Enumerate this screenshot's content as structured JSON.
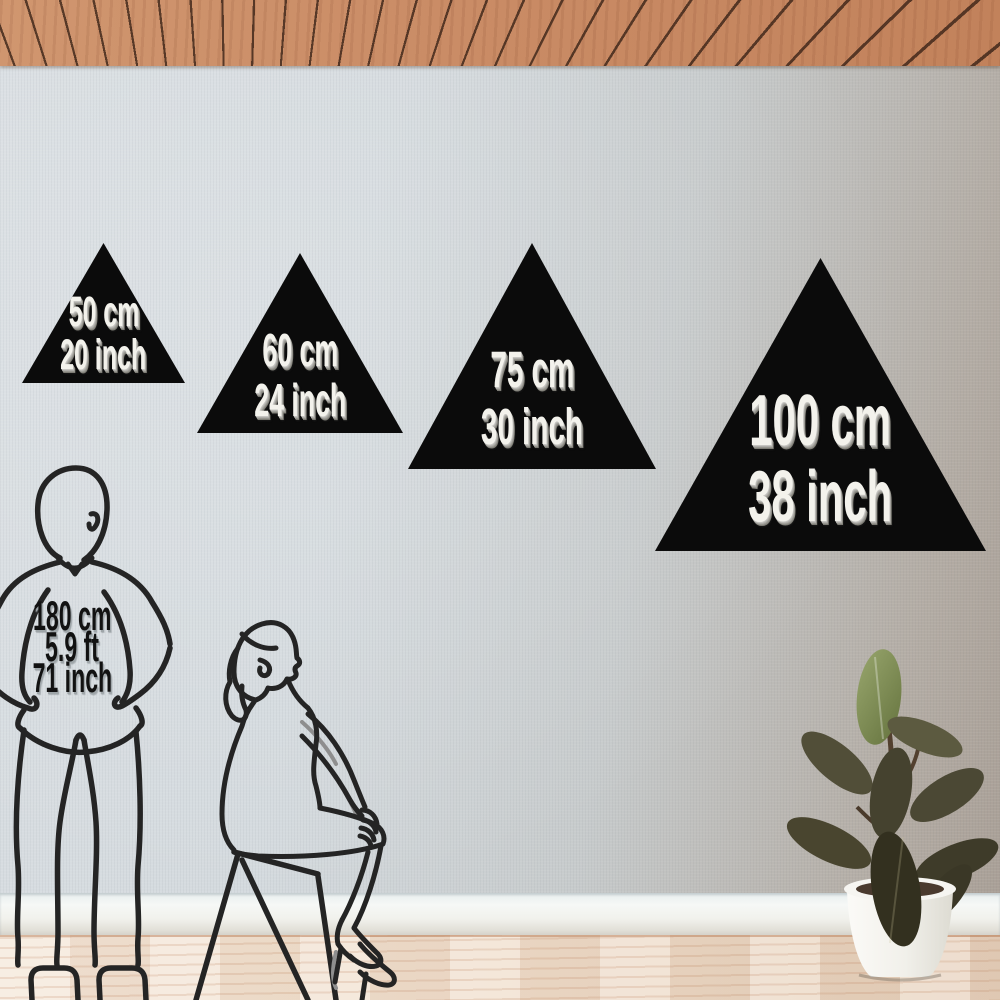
{
  "product": {
    "shape": "triangle",
    "sizes": [
      {
        "cm_label": "50 cm",
        "inch_label": "20 inch"
      },
      {
        "cm_label": "60 cm",
        "inch_label": "24 inch"
      },
      {
        "cm_label": "75 cm",
        "inch_label": "30 inch"
      },
      {
        "cm_label": "100 cm",
        "inch_label": "38 inch"
      }
    ]
  },
  "reference_figure": {
    "cm_label": "180 cm",
    "ft_label": "5.9 ft",
    "inch_label": "71 inch"
  },
  "scene": {
    "elements": [
      "wood-plank-ceiling",
      "linen-textured-wall",
      "white-baseboard",
      "light-wood-floor",
      "standing-man-outline",
      "seated-woman-outline",
      "stool-outline",
      "rubber-plant-in-white-pot"
    ],
    "colors": {
      "triangle_black": "#0b0b0b",
      "triangle_text": "#f3f2ec",
      "height_text": "#121212",
      "line_art": "#242424",
      "wall_light": "#d6dbdf",
      "wall_dark": "#a89e95",
      "ceiling_wood": "#ca8c66",
      "floor_wood": "#efdcc9",
      "baseboard": "#f3f4f1",
      "pot_white": "#f4f3ef",
      "leaf_dark": "#45422f",
      "leaf_light": "#86945c"
    }
  }
}
